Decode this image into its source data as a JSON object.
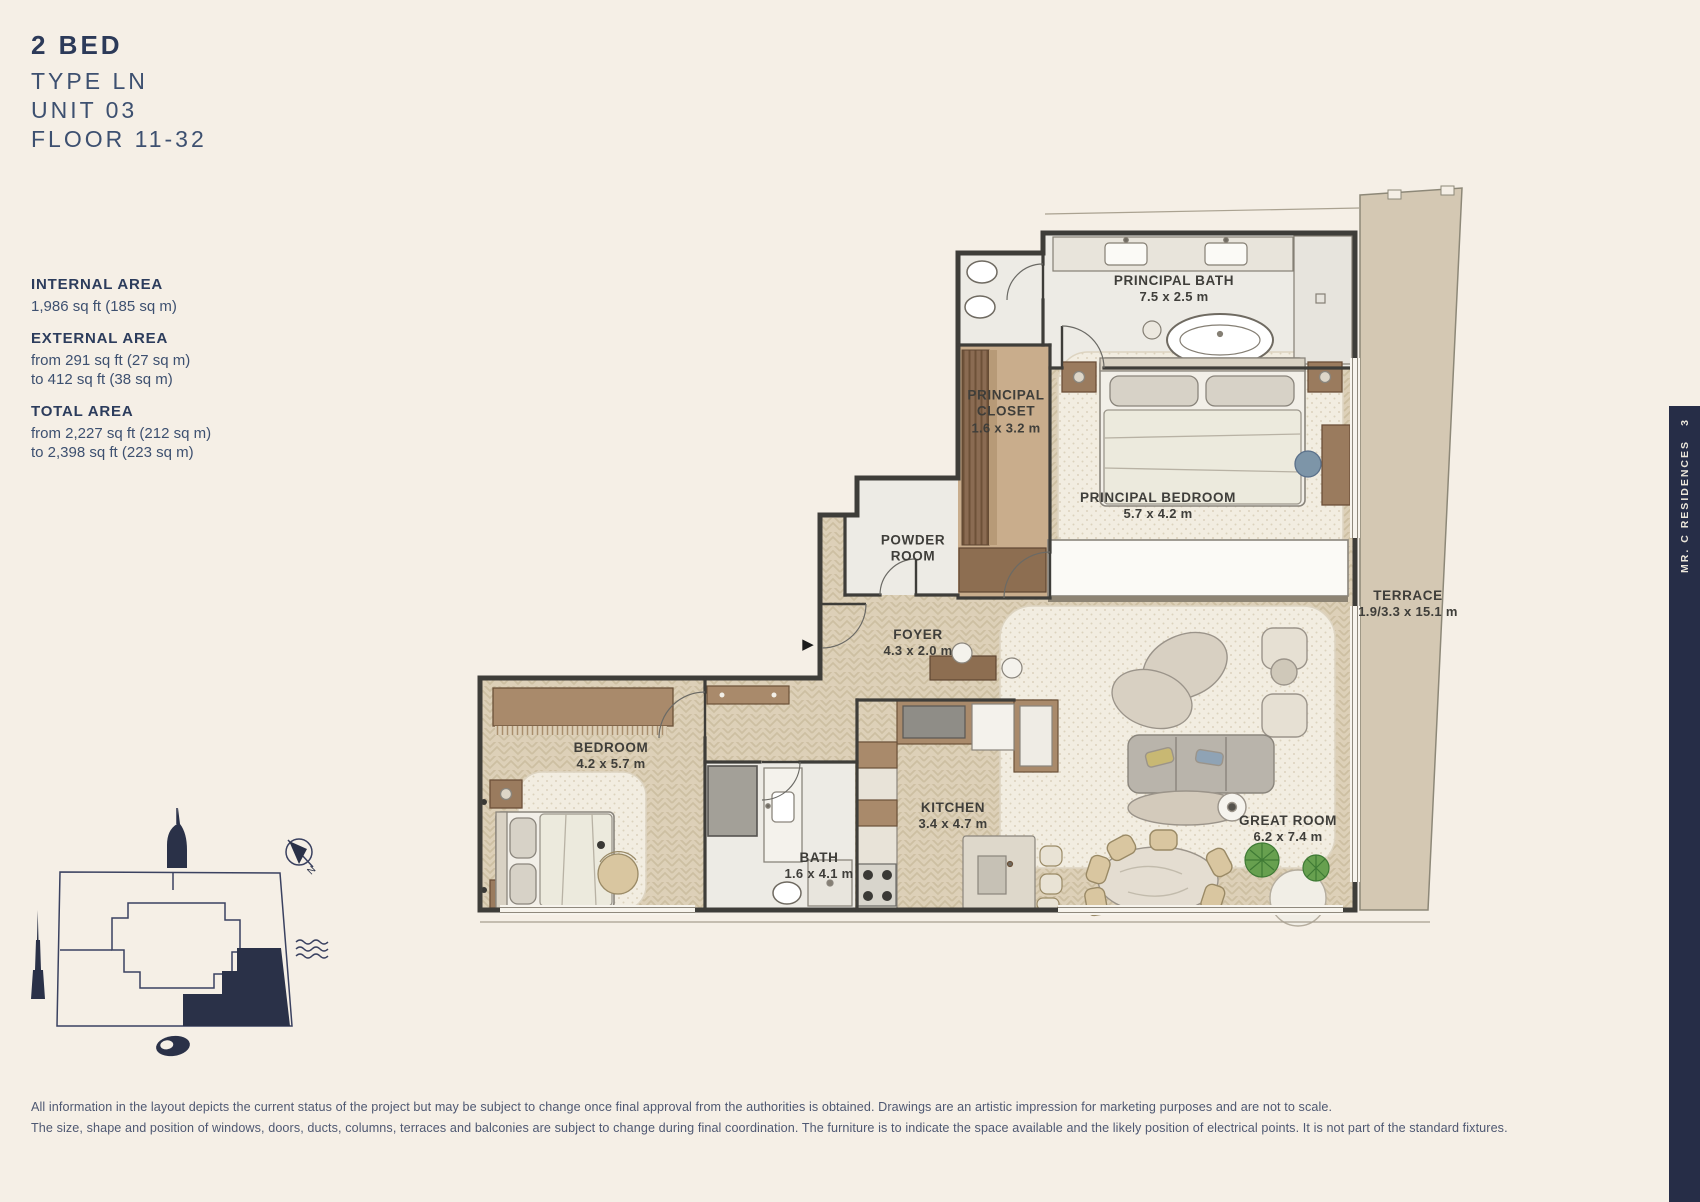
{
  "header": {
    "title": "2 BED",
    "type_line": "TYPE LN",
    "unit_line": "UNIT 03",
    "floor_line": "FLOOR 11-32"
  },
  "areas": [
    {
      "label": "INTERNAL AREA",
      "lines": [
        "1,986 sq ft (185 sq m)",
        ""
      ]
    },
    {
      "label": "EXTERNAL AREA",
      "lines": [
        "from 291 sq ft (27 sq m)",
        "to 412 sq ft (38 sq m)"
      ]
    },
    {
      "label": "TOTAL AREA",
      "lines": [
        "from 2,227 sq ft (212 sq m)",
        "to 2,398 sq ft (223 sq m)"
      ]
    }
  ],
  "plan": {
    "entry_arrow": "▶",
    "rooms": [
      {
        "id": "principal-bath",
        "name": "PRINCIPAL BATH",
        "dims": "7.5 x 2.5 m"
      },
      {
        "id": "principal-closet",
        "name": "PRINCIPAL CLOSET",
        "dims": "1.6 x 3.2 m"
      },
      {
        "id": "principal-bedroom",
        "name": "PRINCIPAL BEDROOM",
        "dims": "5.7 x 4.2 m"
      },
      {
        "id": "powder-room",
        "name": "POWDER ROOM",
        "dims": ""
      },
      {
        "id": "foyer",
        "name": "FOYER",
        "dims": "4.3 x 2.0 m"
      },
      {
        "id": "bedroom",
        "name": "BEDROOM",
        "dims": "4.2 x 5.7 m"
      },
      {
        "id": "bath",
        "name": "BATH",
        "dims": "1.6 x 4.1 m"
      },
      {
        "id": "kitchen",
        "name": "KITCHEN",
        "dims": "3.4 x 4.7 m"
      },
      {
        "id": "great-room",
        "name": "GREAT ROOM",
        "dims": "6.2 x 7.4 m"
      },
      {
        "id": "terrace",
        "name": "TERRACE",
        "dims": "1.9/3.3 x 15.1 m"
      }
    ]
  },
  "key_plan": {
    "compass_label": "N"
  },
  "sidebar": {
    "brand": "MR. C RESIDENCES",
    "page_number": "3",
    "color": "#262d47"
  },
  "footer": {
    "lines": [
      "All information in the layout depicts the current status of the project but may be subject to change once final approval from the authorities is obtained. Drawings are an artistic impression for marketing purposes and are not to scale.",
      "The size, shape and position of windows, doors, ducts, columns, terraces and balconies are subject to change during final coordination. The furniture is to indicate the space available and the likely position of electrical points. It is not part of the standard fixtures."
    ]
  },
  "colors": {
    "background": "#f5efe6",
    "navy": "#262d47",
    "heading": "#2c3a59",
    "body_text": "#3d5070",
    "wood_floor": "#ddd0b8",
    "marble": "#edebe5",
    "terrace": "#d4c8b3",
    "wall": "#3e3d39"
  }
}
